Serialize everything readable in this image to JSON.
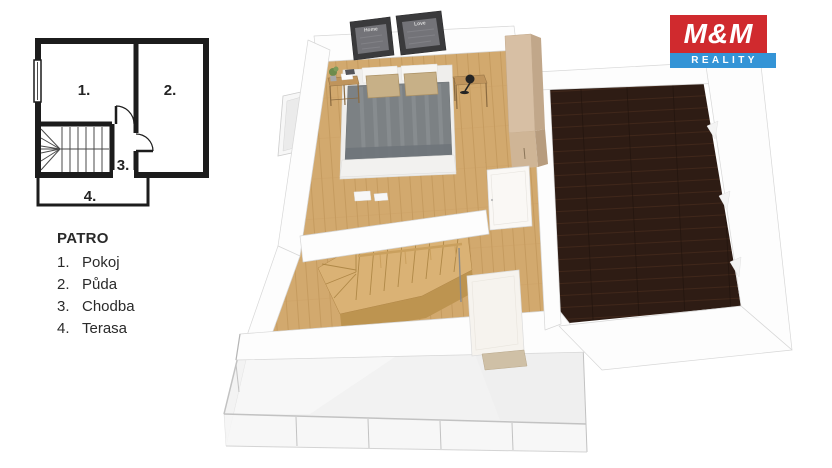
{
  "legend": {
    "title": "PATRO",
    "items": [
      {
        "num": "1.",
        "label": "Pokoj"
      },
      {
        "num": "2.",
        "label": "Půda"
      },
      {
        "num": "3.",
        "label": "Chodba"
      },
      {
        "num": "4.",
        "label": "Terasa"
      }
    ]
  },
  "plan2d": {
    "labels": {
      "room1": "1.",
      "room2": "2.",
      "room3": "3.",
      "room4": "4."
    },
    "wall_color": "#1c1c1c"
  },
  "plan3d": {
    "posters": [
      {
        "label": "Home"
      },
      {
        "label": "Love"
      }
    ],
    "colors": {
      "bedroom_floor": "#d2a96e",
      "plank_line": "#b7894d",
      "attic_floor": "#2e1c14",
      "stairs_wood": "#dab275",
      "stairs_side": "#bd9450",
      "wardrobe": "#d7bfa4",
      "bed_duvet": "#7c8184",
      "pillow": "#c7b087",
      "wall": "#fdfdfd",
      "wall_edge": "#d7d7d7",
      "terrace_floor": "#f2f2f2",
      "railing": "#c2c2c2",
      "doormat": "#cfc0a6"
    }
  },
  "logo": {
    "top": "M&M",
    "bottom": "REALITY",
    "red": "#d02a2e",
    "blue": "#3494d6",
    "text": "#ffffff"
  }
}
